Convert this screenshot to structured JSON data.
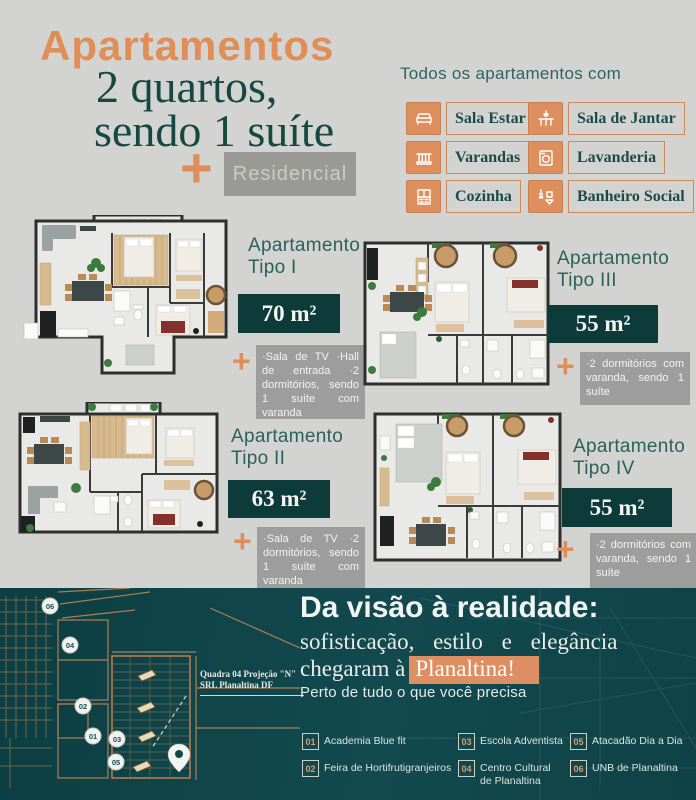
{
  "palette": {
    "orange": "#df8e5a",
    "teal_dark_box": "#0c3b3a",
    "teal_text": "#15493f",
    "footer_background": "#0f454a",
    "gray_box": "#9d9d9d",
    "highlight_orange": "#dd8e62"
  },
  "header": {
    "title": "Apartamentos",
    "subtitle_line1": "2 quartos,",
    "subtitle_line2": "sendo 1 suíte",
    "plus": "+",
    "residencial": "Residencial"
  },
  "amenities": {
    "heading": "Todos os apartamentos com",
    "items": [
      {
        "icon": "sofa-icon",
        "label": "Sala Estar"
      },
      {
        "icon": "dining-table-icon",
        "label": "Sala de Jantar"
      },
      {
        "icon": "balcony-icon",
        "label": "Varandas"
      },
      {
        "icon": "washing-machine-icon",
        "label": "Lavanderia"
      },
      {
        "icon": "kitchen-icon",
        "label": "Cozinha"
      },
      {
        "icon": "bathroom-icon",
        "label": "Banheiro Social"
      }
    ]
  },
  "apartments": [
    {
      "label_line1": "Apartamento",
      "label_line2": "Tipo I",
      "area": "70 m²",
      "plus": "+",
      "description": "·Sala de TV ·Hall de entrada ·2 dormitórios, sendo 1 suíte com varanda"
    },
    {
      "label_line1": "Apartamento",
      "label_line2": "Tipo II",
      "area": "63 m²",
      "plus": "+",
      "description": "·Sala de TV ·2 dormitórios, sendo 1 suíte com varanda"
    },
    {
      "label_line1": "Apartamento",
      "label_line2": "Tipo III",
      "area": "55 m²",
      "plus": "+",
      "description": "·2 dormitórios com varanda, sendo 1 suíte"
    },
    {
      "label_line1": "Apartamento",
      "label_line2": "Tipo IV",
      "area": "55 m²",
      "plus": "+",
      "description": "·2 dormitórios com varanda, sendo 1 suíte"
    }
  ],
  "footer": {
    "headline": "Da visão à realidade:",
    "line1": "sofisticação, estilo e elegância",
    "line2_prefix": "chegaram à",
    "line2_highlight": "Planaltina!",
    "tagline": "Perto de tudo o que você precisa",
    "map": {
      "label_line1": "Quadra 04 Projeção \"N\"",
      "label_line2": "SRL Planaltina DF",
      "markers": [
        {
          "num": "06"
        },
        {
          "num": "04"
        },
        {
          "num": "02"
        },
        {
          "num": "01"
        },
        {
          "num": "03"
        },
        {
          "num": "05"
        }
      ]
    },
    "pois": [
      {
        "num": "01",
        "label": "Academia Blue fit"
      },
      {
        "num": "02",
        "label": "Feira de Hortifrutigranjeiros"
      },
      {
        "num": "03",
        "label": "Escola Adventista"
      },
      {
        "num": "04",
        "label": "Centro Cultural de Planaltina"
      },
      {
        "num": "05",
        "label": "Atacadão Dia a Dia"
      },
      {
        "num": "06",
        "label": "UNB de Planaltina"
      }
    ]
  }
}
